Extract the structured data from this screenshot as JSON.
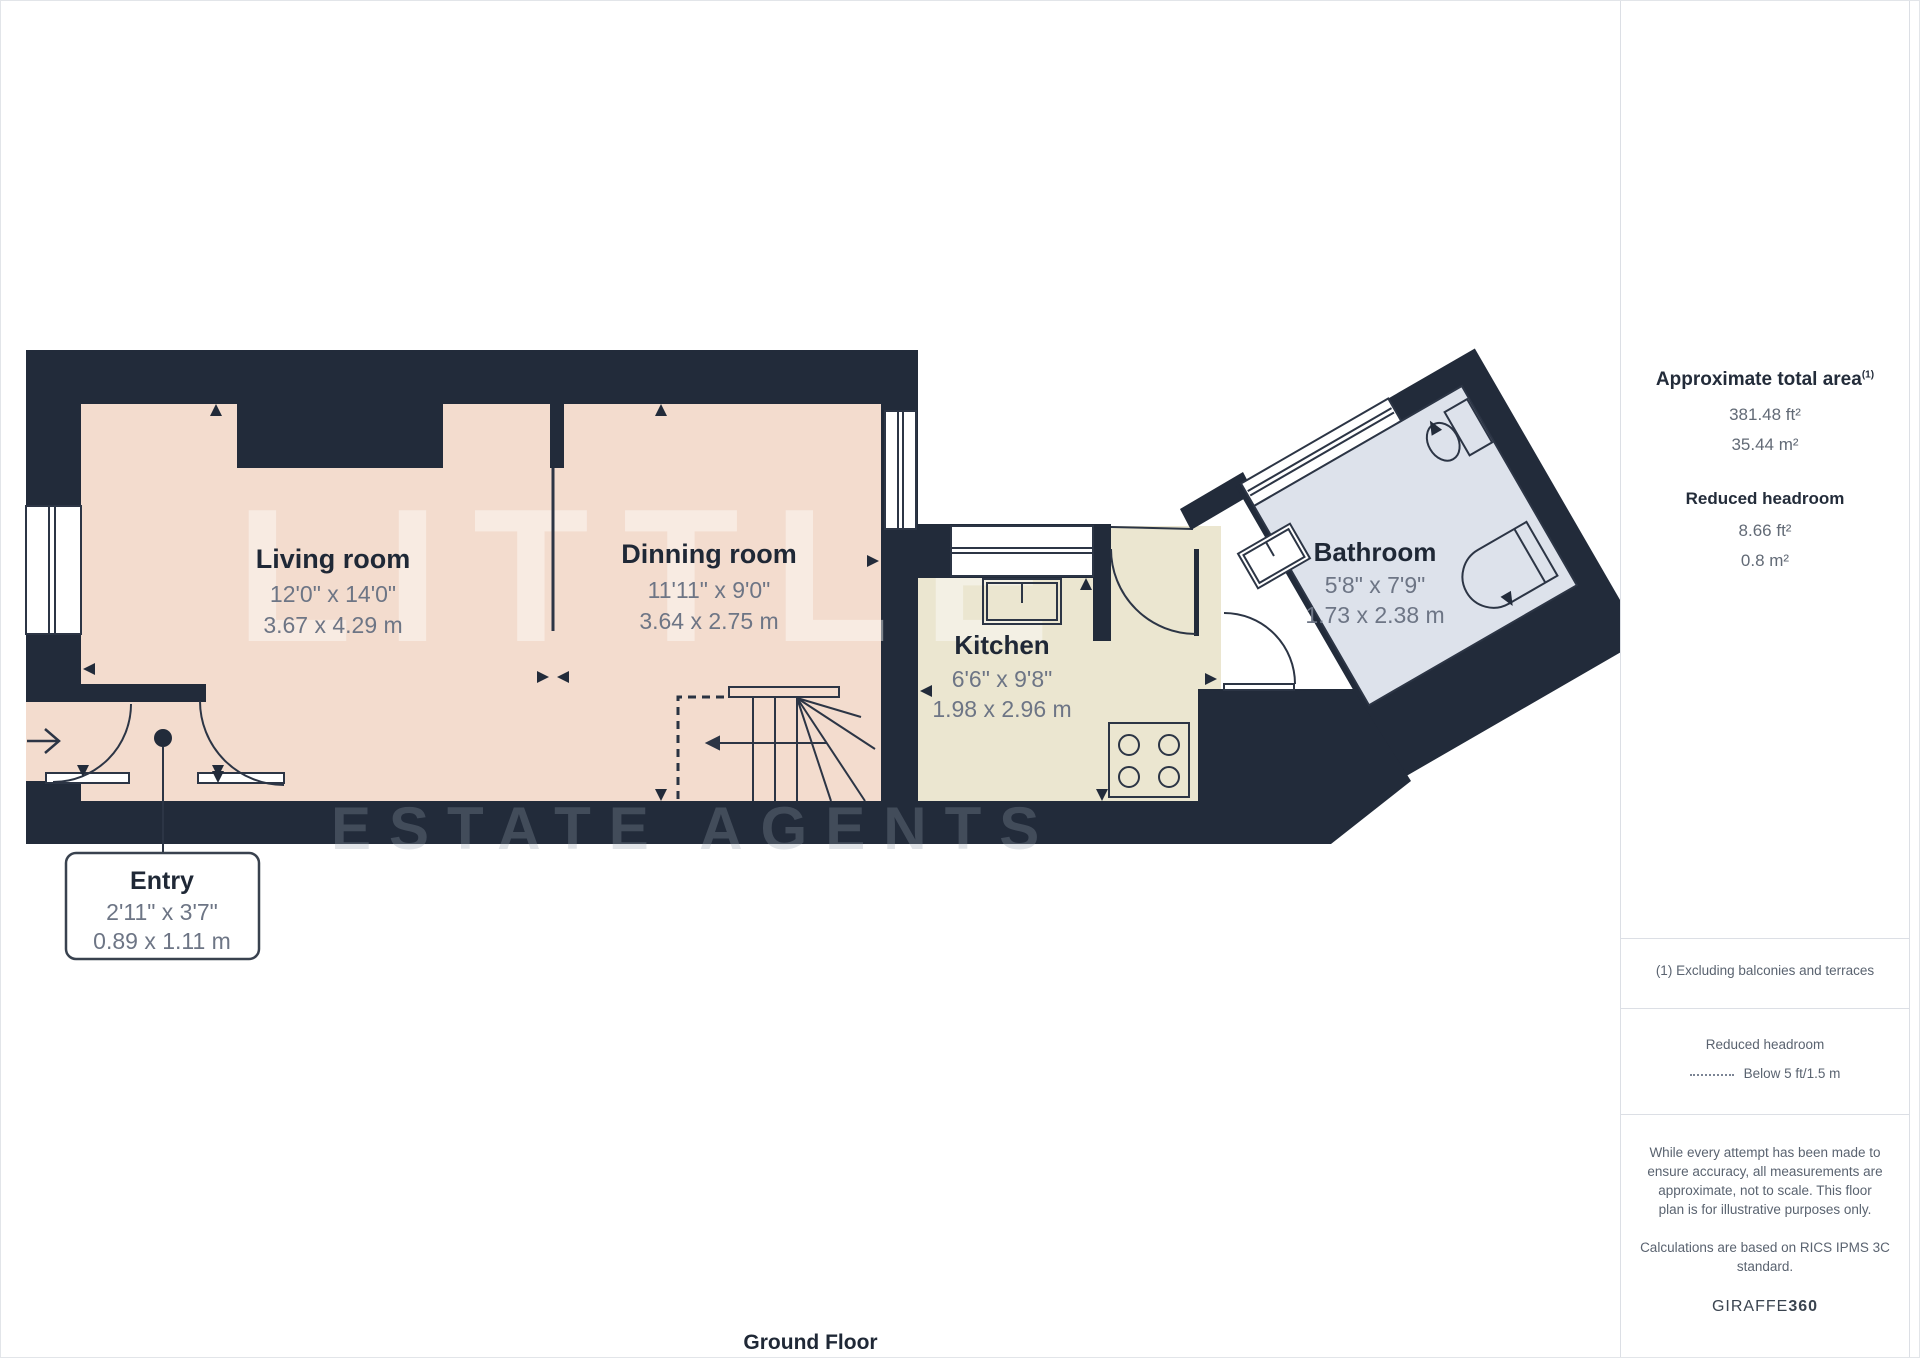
{
  "plan": {
    "rooms": [
      {
        "name": "Living room",
        "dims_ft": "12'0\" x 14'0\"",
        "dims_m": "3.67 x 4.29 m"
      },
      {
        "name": "Dinning room",
        "dims_ft": "11'11\" x 9'0\"",
        "dims_m": "3.64 x 2.75 m"
      },
      {
        "name": "Kitchen",
        "dims_ft": "6'6\" x 9'8\"",
        "dims_m": "1.98 x 2.96 m"
      },
      {
        "name": "Bathroom",
        "dims_ft": "5'8\" x 7'9\"",
        "dims_m": "1.73 x 2.38 m"
      },
      {
        "name": "Entry",
        "dims_ft": "2'11\" x 3'7\"",
        "dims_m": "0.89 x 1.11 m"
      }
    ],
    "floor_label": "Ground Floor",
    "watermark_line1": "LITTLE",
    "watermark_line2": "ESTATE AGENTS",
    "colors": {
      "wall": "#222b3a",
      "living_dinning_floor": "#f3dcce",
      "kitchen_floor": "#ebe6d0",
      "bathroom_floor": "#dde2eb"
    }
  },
  "sidebar": {
    "approx_title": "Approximate total area",
    "approx_sup": "(1)",
    "approx_ft": "381.48 ft²",
    "approx_m": "35.44 m²",
    "reduced_title": "Reduced headroom",
    "reduced_ft": "8.66 ft²",
    "reduced_m": "0.8 m²",
    "note_excluding": "(1) Excluding balconies and terraces",
    "legend_title": "Reduced headroom",
    "legend_item": "Below 5 ft/1.5 m",
    "disclaimer": [
      "While every attempt has been made to",
      "ensure accuracy, all measurements are",
      "approximate, not to scale. This floor",
      "plan is for illustrative purposes only."
    ],
    "calc": [
      "Calculations are based on RICS IPMS 3C",
      "standard."
    ],
    "brand_a": "GIRAFFE",
    "brand_b": "360"
  }
}
